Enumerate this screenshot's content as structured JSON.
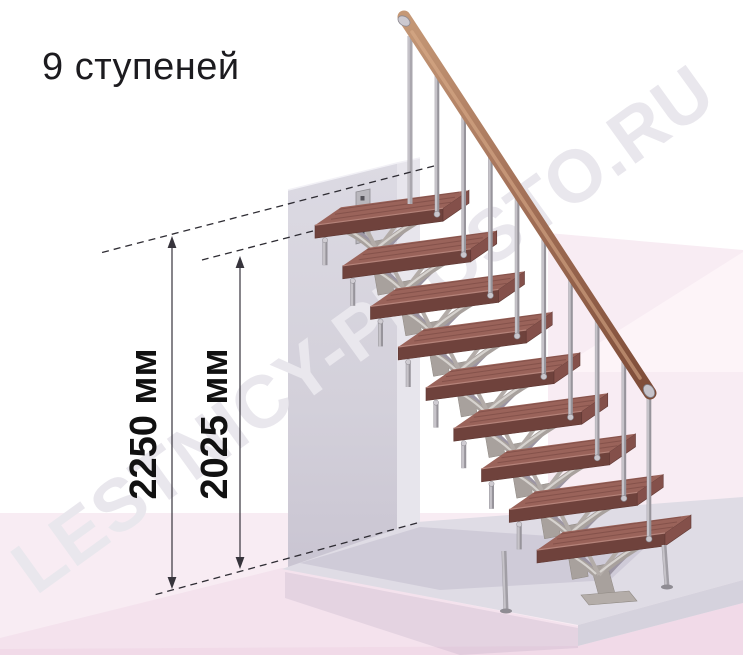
{
  "title": {
    "text": "9 ступеней"
  },
  "watermark": {
    "text": "LESTNICY-PROSTO.RU"
  },
  "annotations": {
    "total_height": {
      "label": "2250 мм"
    },
    "flight_height": {
      "label": "2025 мм"
    }
  },
  "staircase": {
    "steps_count": 9,
    "balusters_count": 9,
    "description": "modular straight staircase with wood treads, central support modules, metal balusters and wood handrail"
  },
  "colors": {
    "background": "#ffffff",
    "pink_main": "#f8ecf3",
    "pink_light": "#fdf4f8",
    "pink_deep": "#f4e2ed",
    "pink_strip": "#f1dae8",
    "wall_front_top": "#dcdae3",
    "wall_front_mid": "#d3d0da",
    "wall_front_bottom": "#c7c2d0",
    "wall_side": "#e7e5ec",
    "floor_top": "#dfdce5",
    "floor_front": "#d5d2dd",
    "shadow": "#8c81a0",
    "line": "#37343c",
    "text": "#1c1b1f",
    "watermark": "#e9e7ed",
    "metal": "#aaa7ae",
    "metal_light": "#c6c3c9",
    "metal_dark": "#97949b",
    "support": "#a8a19d",
    "support_light": "#d7d3cf",
    "support_far": "#9c95a3",
    "plate": "#b9b7bd",
    "plate_hole": "#55535a",
    "tread_top": "#9a635a",
    "tread_front": "#6f423c",
    "tread_side": "#84504a",
    "tread_edge": "#b5837a",
    "tread_grain": "rgba(80,40,36,0.28)",
    "rail_light": "#c59876",
    "rail_mid": "#a5735a",
    "rail_dark": "#7e4c38",
    "rail_highlight": "#dcae8d"
  }
}
